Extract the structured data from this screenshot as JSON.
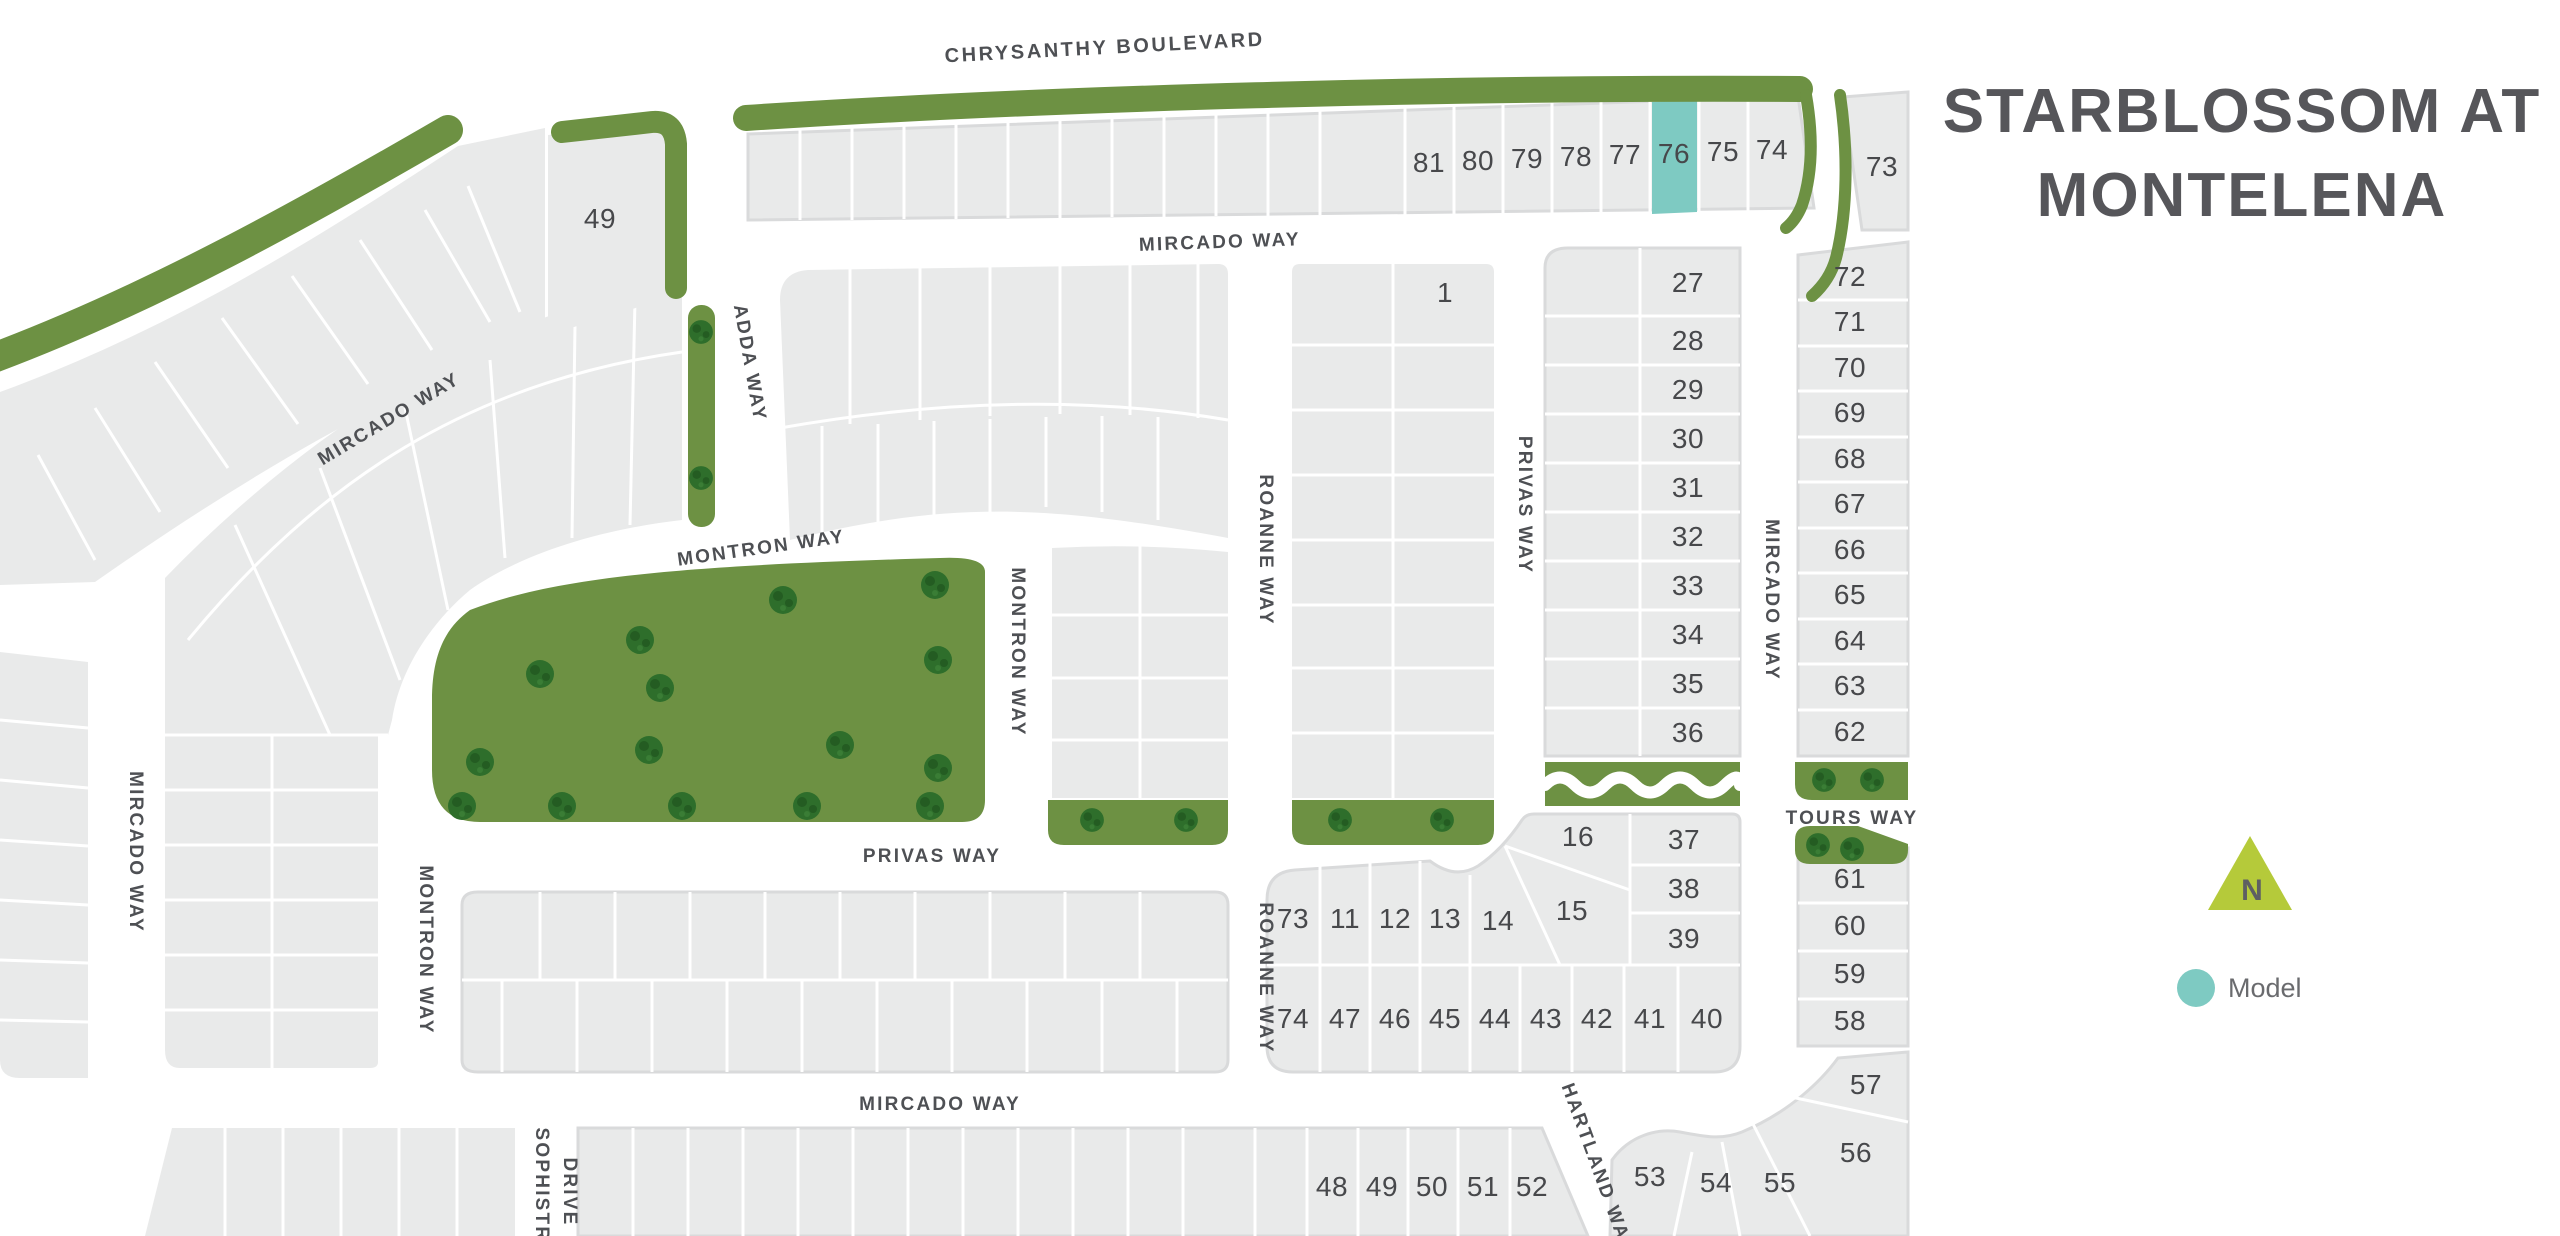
{
  "title": {
    "line1": "STARBLOSSOM AT",
    "line2": "MONTELENA"
  },
  "legend": {
    "north_label": "N",
    "model_label": "Model"
  },
  "streets": {
    "chrysanthy": "CHRYSANTHY BOULEVARD",
    "mircado_top": "MIRCADO WAY",
    "mircado_upper_left": "MIRCADO WAY",
    "mircado_left": "MIRCADO WAY",
    "mircado_right": "MIRCADO WAY",
    "mircado_bottom": "MIRCADO WAY",
    "adda": "ADDA WAY",
    "montron_top": "MONTRON WAY",
    "montron_right": "MONTRON WAY",
    "montron_left": "MONTRON WAY",
    "roanne_upper": "ROANNE WAY",
    "roanne_lower": "ROANNE WAY",
    "privas_vertical": "PRIVAS WAY",
    "privas_bottom": "PRIVAS WAY",
    "tours": "TOURS WAY",
    "hartland": "HARTLAND WAY",
    "sophistry_line1": "SOPHISTRY",
    "sophistry_line2": "DRIVE"
  },
  "lots": {
    "labels": [
      "49",
      "1",
      "81",
      "80",
      "79",
      "78",
      "77",
      "76",
      "75",
      "74",
      "73",
      "72",
      "71",
      "70",
      "69",
      "68",
      "67",
      "66",
      "65",
      "64",
      "63",
      "62",
      "27",
      "28",
      "29",
      "30",
      "31",
      "32",
      "33",
      "34",
      "35",
      "36",
      "37",
      "38",
      "39",
      "16",
      "15",
      "73",
      "11",
      "12",
      "13",
      "14",
      "74",
      "47",
      "46",
      "45",
      "44",
      "43",
      "42",
      "41",
      "40",
      "61",
      "60",
      "59",
      "58",
      "57",
      "56",
      "55",
      "54",
      "53",
      "48",
      "49",
      "50",
      "51",
      "52"
    ],
    "model_lot": "76"
  },
  "colors": {
    "model_teal": "#7ecac2",
    "north_lime": "#b5ca3a",
    "greenbelt": "#6d9143",
    "tree": "#2e6e2b",
    "lot_gray": "#e9eaea",
    "curb_gray": "#d9dadb",
    "label_text": "#4e5054",
    "title_text": "#56565a"
  }
}
